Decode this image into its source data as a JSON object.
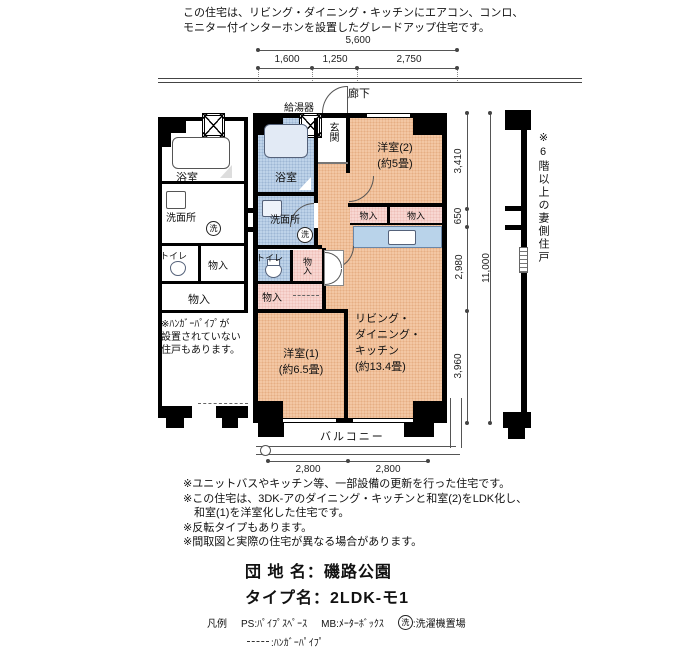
{
  "header": {
    "line1": "この住宅は、リビング・ダイニング・キッチンにエアコン、コンロ、",
    "line2": "モニター付インターホンを設置したグレードアップ住宅です。"
  },
  "dimensions": {
    "top_total": "5,600",
    "top_segments": [
      "1,600",
      "1,250",
      "2,750"
    ],
    "right_segments": [
      "3,410",
      "650",
      "2,980",
      "3,960"
    ],
    "right_total": "11,000",
    "bottom_segments": [
      "2,800",
      "2,800"
    ]
  },
  "plan": {
    "corridor": "廊下",
    "balcony": "バルコニー",
    "water_heater": "給湯器",
    "entrance": "玄関",
    "bath": "浴室",
    "washroom": "洗面所",
    "toilet": "トイレ",
    "closet": "物入",
    "room2_name": "洋室(2)",
    "room2_size": "(約5畳)",
    "room1_name": "洋室(1)",
    "room1_size": "(約6.5畳)",
    "ldk_line1": "リビング・",
    "ldk_line2": "ダイニング・",
    "ldk_line3": "キッチン",
    "ldk_size": "(約13.4畳)",
    "laundry_symbol": "洗"
  },
  "notes": {
    "left": [
      "※ﾊﾝｶﾞｰﾊﾟｲﾌﾟが",
      "設置されていない",
      "住戸もあります。"
    ],
    "right_vertical": "※6階以上の妻側住戸",
    "bottom": [
      "※ユニットバスやキッチン等、一部設備の更新を行った住宅です。",
      "※この住宅は、3DK-アのダイニング・キッチンと和室(2)をLDK化し、",
      "　和室(1)を洋室化した住宅です。",
      "※反転タイプもあります。",
      "※間取図と実際の住宅が異なる場合があります。"
    ]
  },
  "estate": {
    "name_label": "団 地 名：",
    "name_value": "磯路公園",
    "type_label": "タイプ名：",
    "type_value": "2LDK-モ1"
  },
  "legend": {
    "title": "凡例",
    "ps": "PS:ﾊﾟｲﾌﾟｽﾍﾟｰｽ",
    "mb": "MB:ﾒｰﾀｰﾎﾞｯｸｽ",
    "laundry_suffix": ":洗濯機置場",
    "hanger_suffix": ":ﾊﾝｶﾞｰﾊﾟｲﾌﾟ"
  },
  "colors": {
    "room_peach": "#f3c7a4",
    "wet_blue": "#bed3e9",
    "closet_pink": "#f8d7d2",
    "tub_blue": "#e2eaf5",
    "wall": "#000000"
  }
}
